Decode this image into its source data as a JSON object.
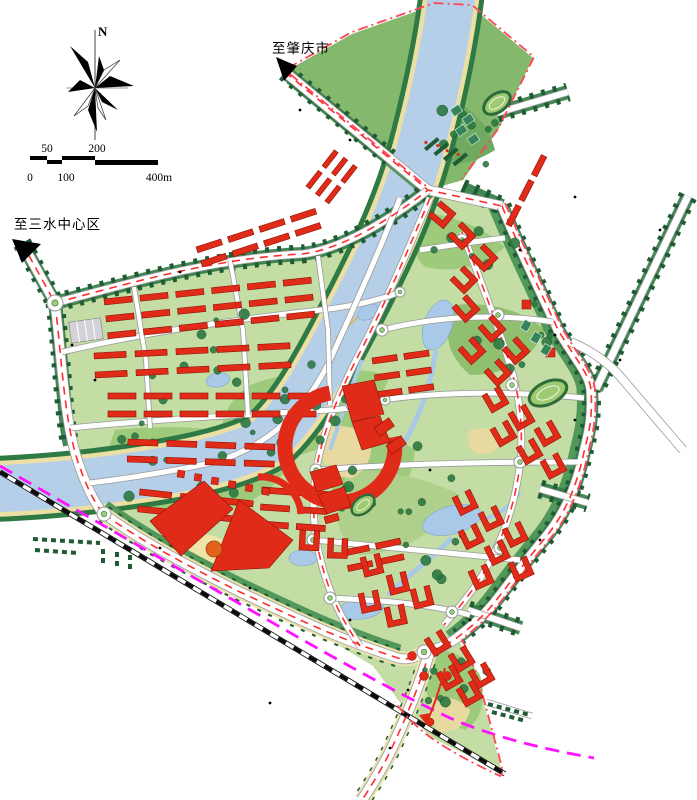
{
  "compass": {
    "north_label": "N"
  },
  "scale_bar": {
    "upper_ticks": [
      "50",
      "200"
    ],
    "lower_ticks": [
      "0",
      "100",
      "400m"
    ]
  },
  "direction_labels": {
    "northwest_road": "至肇庆市",
    "west_road": "至三水中心区"
  },
  "palette": {
    "river_blue": "#b6cfe8",
    "pond_blue": "#a9c9e8",
    "site_green": "#c3dda4",
    "park_green": "#9dca7b",
    "wedge_green": "#84b86d",
    "band_green": "#52985a",
    "hedge_green": "#2f7a44",
    "tree_green": "#1f5c33",
    "building_red": "#e02b18",
    "building_edge": "#8e1206",
    "sand_yellow": "#ecdfa4",
    "plaza_tan": "#e8d9a0",
    "road_white": "#ffffff",
    "road_casing": "#9a9a9a",
    "road_dash_red": "#ff2d2d",
    "railway_black": "#0a0a0a",
    "metro_magenta": "#ff12ff",
    "boundary_pink": "#ff4456",
    "parking_gray": "#d2d2d8",
    "accent_orange": "#e2641b"
  }
}
